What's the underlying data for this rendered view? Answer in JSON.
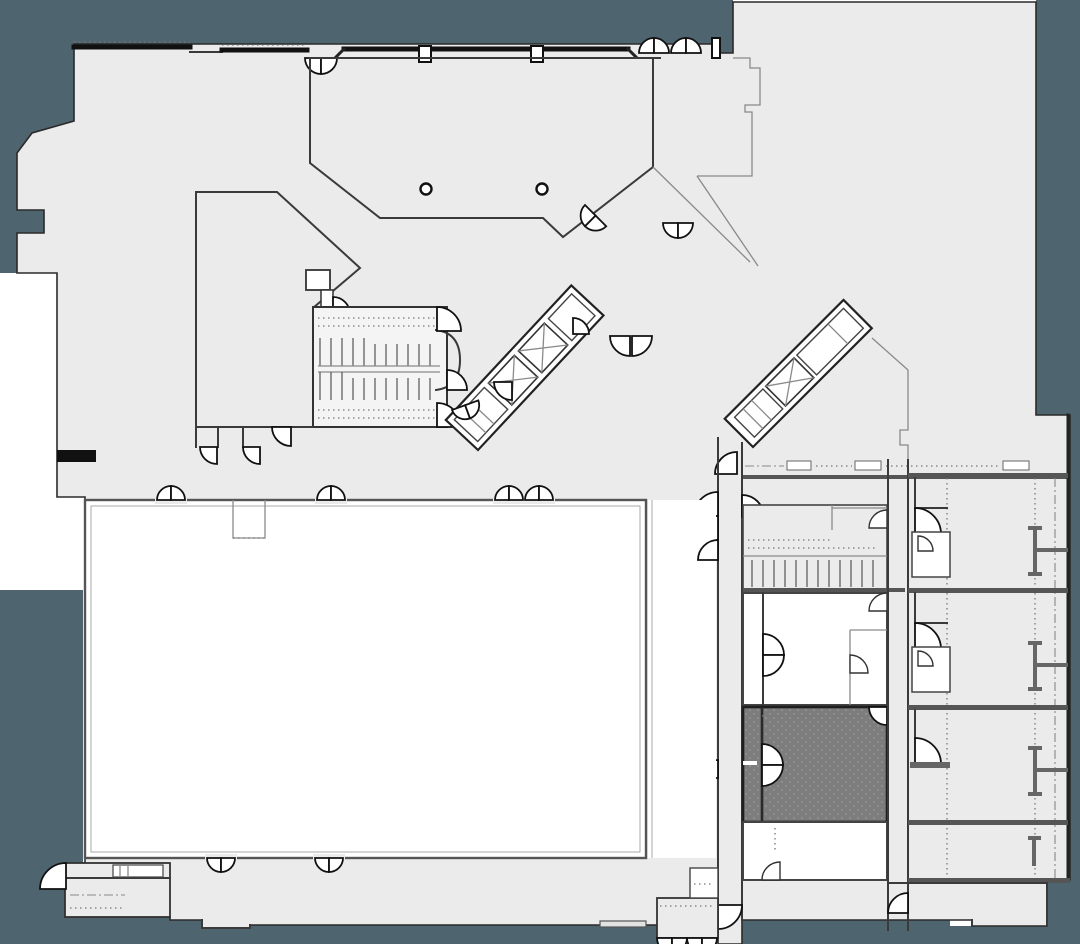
{
  "canvas": {
    "width": 1080,
    "height": 944
  },
  "colors": {
    "background_dark": "#4e646e",
    "page_white": "#ffffff",
    "floor_fill": "#ebebeb",
    "room_fill": "#ffffff",
    "wall_dark": "#111111",
    "wall_mid": "#3a3a3a",
    "wall_light": "#8a8a8a",
    "highlight_fill": "#7d7d7d",
    "highlight_dot": "#9a9a9a",
    "stair_fill": "#f4f4f4"
  },
  "plan": {
    "type": "hotel-floor-plan",
    "selected_room": {
      "id": "selected-room",
      "state": "highlighted",
      "fill": "#7d7d7d"
    },
    "regions": [
      {
        "id": "atrium-room",
        "kind": "function-room"
      },
      {
        "id": "west-room",
        "kind": "function-room"
      },
      {
        "id": "ballroom",
        "kind": "ballroom"
      },
      {
        "id": "stair-block-west",
        "kind": "stairs"
      },
      {
        "id": "elevator-bank-central",
        "kind": "elevators",
        "cars": 2
      },
      {
        "id": "elevator-bank-east",
        "kind": "elevators",
        "cars": 1
      },
      {
        "id": "guest-room-1",
        "kind": "guest-room"
      },
      {
        "id": "guest-room-2",
        "kind": "guest-room"
      },
      {
        "id": "guest-room-3",
        "kind": "guest-room"
      },
      {
        "id": "meeting-room-upper",
        "kind": "meeting-room"
      },
      {
        "id": "meeting-room-lower",
        "kind": "meeting-room"
      },
      {
        "id": "selected-room",
        "kind": "meeting-room"
      },
      {
        "id": "corridor-main",
        "kind": "corridor"
      },
      {
        "id": "entrance-vestibule-south",
        "kind": "entrance"
      },
      {
        "id": "entrance-vestibule-west",
        "kind": "entrance"
      }
    ]
  }
}
